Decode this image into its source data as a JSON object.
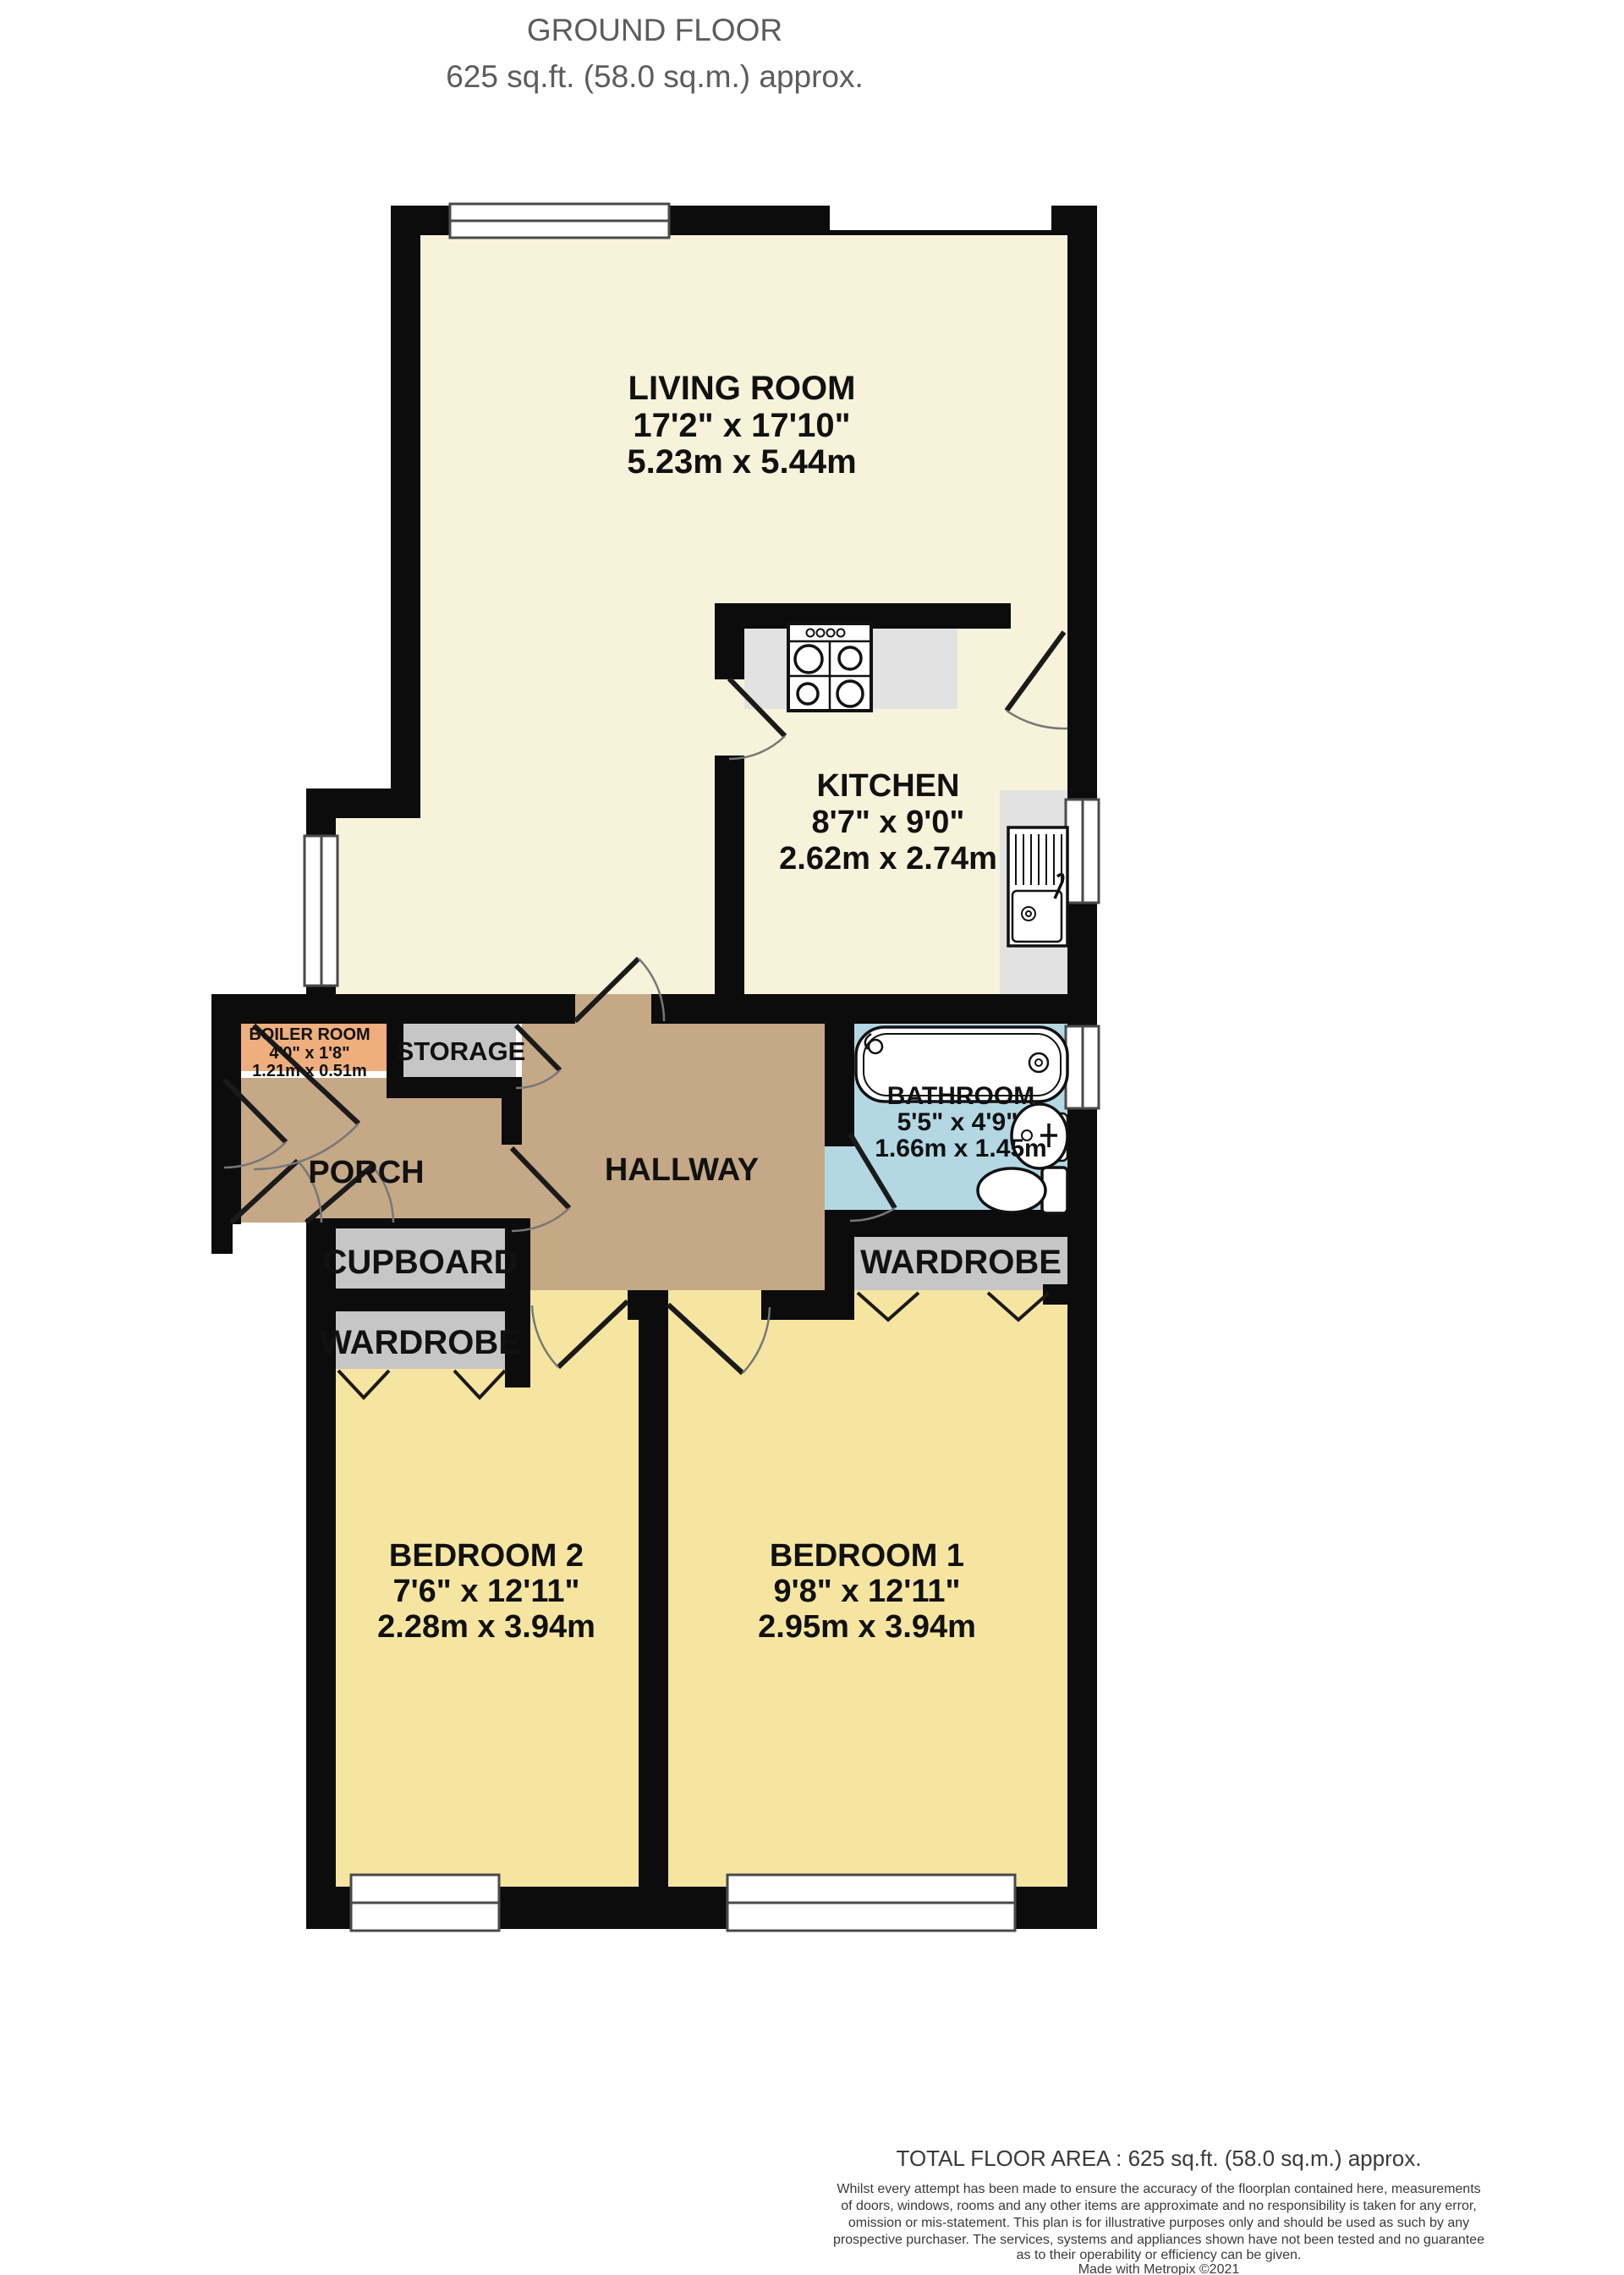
{
  "header": {
    "title": "GROUND FLOOR",
    "subtitle": "625 sq.ft. (58.0 sq.m.) approx."
  },
  "rooms": {
    "living_room": {
      "name": "LIVING ROOM",
      "imperial": "17'2\" x 17'10\"",
      "metric": "5.23m x 5.44m"
    },
    "kitchen": {
      "name": "KITCHEN",
      "imperial": "8'7\" x 9'0\"",
      "metric": "2.62m x 2.74m"
    },
    "boiler_room": {
      "name": "BOILER ROOM",
      "imperial": "4'0\" x 1'8\"",
      "metric": "1.21m x 0.51m"
    },
    "storage": {
      "name": "STORAGE"
    },
    "porch": {
      "name": "PORCH"
    },
    "hallway": {
      "name": "HALLWAY"
    },
    "bathroom": {
      "name": "BATHROOM",
      "imperial": "5'5\" x 4'9\"",
      "metric": "1.66m x 1.45m"
    },
    "cupboard": {
      "name": "CUPBOARD"
    },
    "wardrobe_left": {
      "name": "WARDROBE"
    },
    "wardrobe_right": {
      "name": "WARDROBE"
    },
    "bedroom_2": {
      "name": "BEDROOM 2",
      "imperial": "7'6\" x 12'11\"",
      "metric": "2.28m x 3.94m"
    },
    "bedroom_1": {
      "name": "BEDROOM 1",
      "imperial": "9'8\" x 12'11\"",
      "metric": "2.95m x 3.94m"
    }
  },
  "footer": {
    "total_area": "TOTAL FLOOR AREA : 625 sq.ft. (58.0 sq.m.) approx.",
    "disclaimer": [
      "Whilst every attempt has been made to ensure the accuracy of the floorplan contained here, measurements",
      "of doors, windows, rooms and any other items are approximate and no responsibility is taken for any error,",
      "omission or mis-statement. This plan is for illustrative purposes only and should be used as such by any",
      "prospective purchaser. The services, systems and appliances shown have not been tested and no guarantee",
      "as to their operability or efficiency can be given."
    ],
    "credit": "Made with Metropix ©2021"
  },
  "colors": {
    "living_kitchen_floor": "#f7f2da",
    "hall_porch_floor": "#c5a886",
    "bedroom_floor": "#f5e5a1",
    "storage_gray": "#c6c6c6",
    "counter_gray": "#e2e2e2",
    "boiler_orange": "#efae7d",
    "bathroom_blue": "#b3d8e4",
    "wall_black": "#0c0c0c",
    "header_gray": "#5c5c5c"
  }
}
